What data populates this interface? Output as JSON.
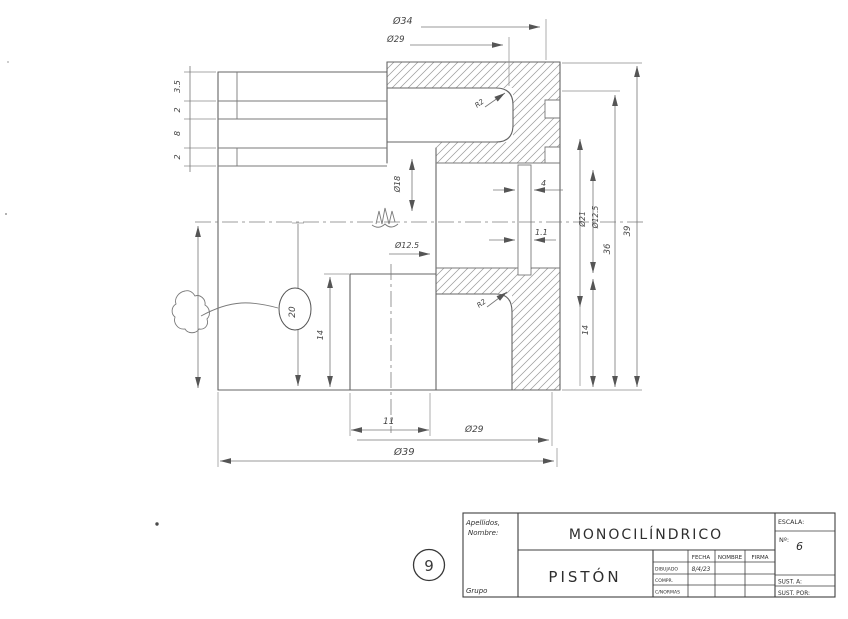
{
  "colors": {
    "paper": "#ffffff",
    "pencil": "#6a6a6a",
    "ink": "#333333"
  },
  "dims": {
    "dia34": "Ø34",
    "dia29_top": "Ø29",
    "ring1": "3.5",
    "ring2": "2",
    "ring3": "8",
    "ring4": "2",
    "dia18": "Ø18",
    "dia125_bore": "Ø12.5",
    "pin_4": "4",
    "pin_11": "1.1",
    "dia21": "Ø21",
    "dia125_pin": "Ø12.5",
    "h14_right": "14",
    "h36": "36",
    "h39": "39",
    "h20": "20",
    "h14_left": "14",
    "w11": "11",
    "dia29_bottom": "Ø29",
    "dia39": "Ø39",
    "r2_bowl": "R2",
    "r2_skirt": "R2"
  },
  "notes": {
    "sheet_number": "9"
  },
  "title_block": {
    "apellidos": "Apellidos,",
    "nombre": "Nombre:",
    "grupo": "Grupo",
    "title": "MONOCILÍNDRICO",
    "part": "PISTÓN",
    "escala": "ESCALA:",
    "num_label": "Nº:",
    "num": "6",
    "sust_a": "SUST. A:",
    "sust_por": "SUST. POR:",
    "table": {
      "headers": [
        "FECHA",
        "NOMBRE",
        "FIRMA"
      ],
      "rows": [
        {
          "label": "DIBUJADO",
          "fecha": "8/4/23"
        },
        {
          "label": "COMPR.",
          "fecha": ""
        },
        {
          "label": "C/NORMAS",
          "fecha": ""
        }
      ]
    }
  }
}
